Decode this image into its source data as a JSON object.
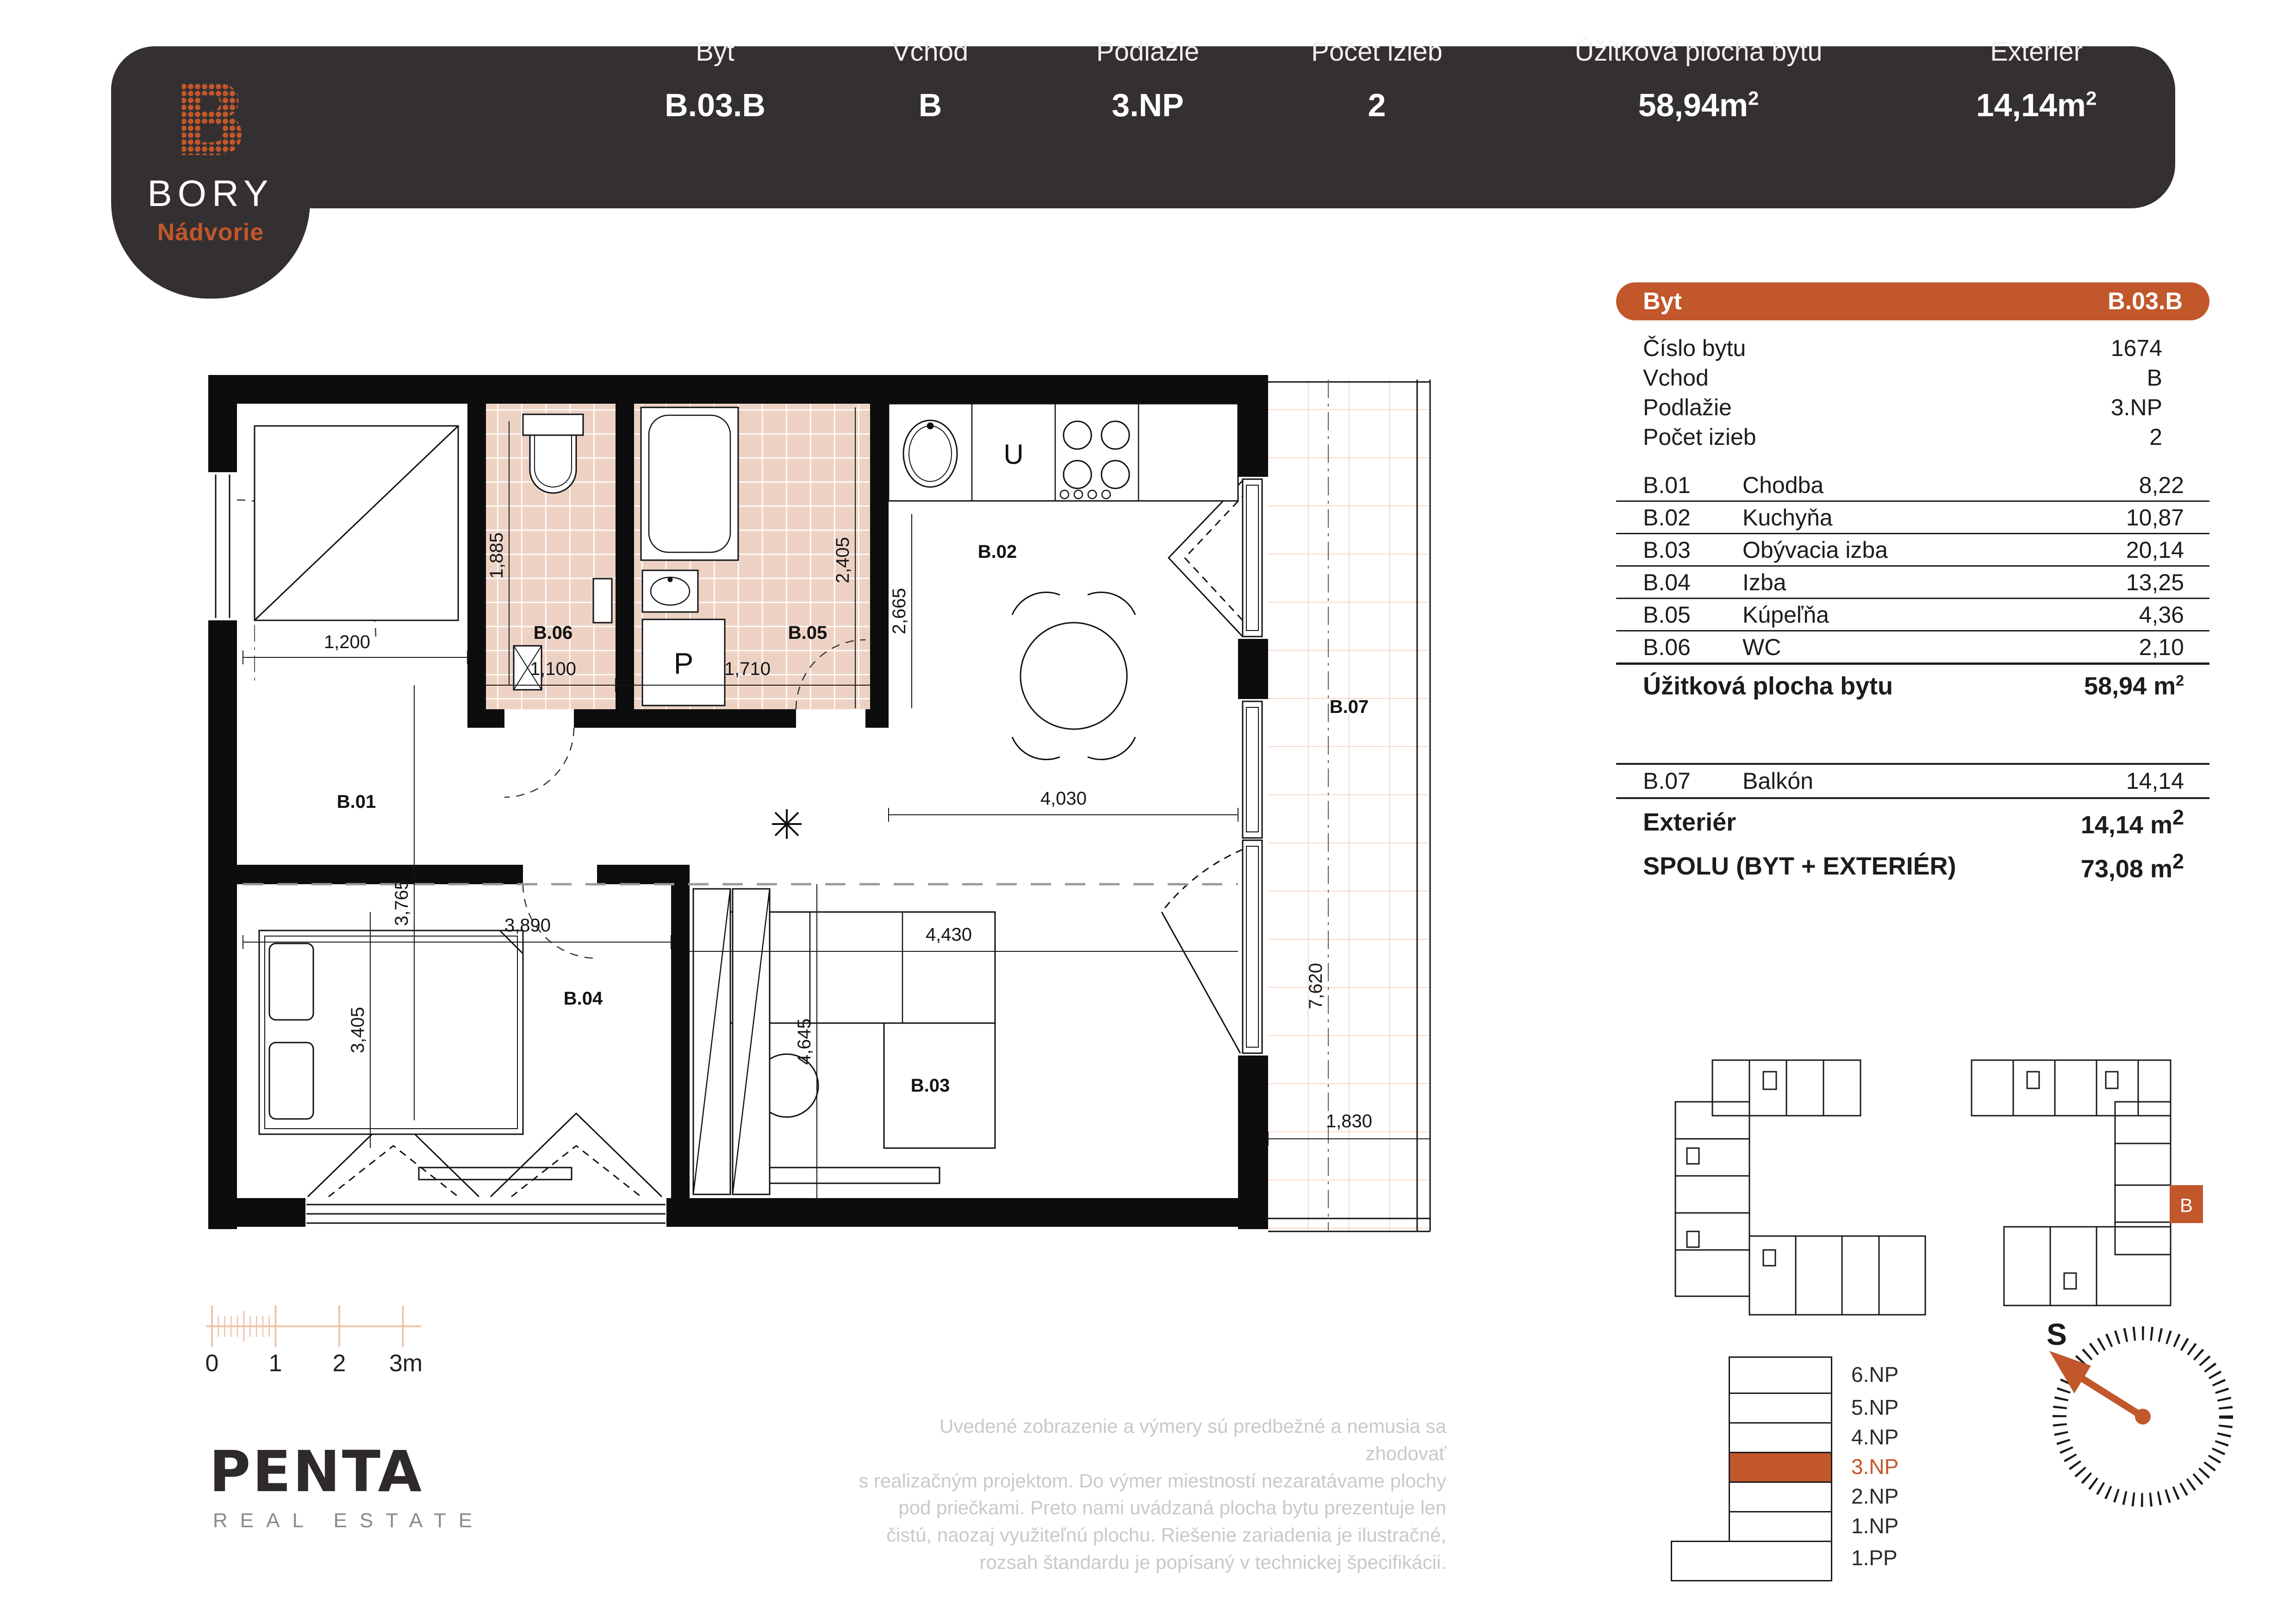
{
  "header": {
    "logo": {
      "letter": "B",
      "brand": "BORY",
      "sub": "Nádvorie"
    },
    "fields": [
      {
        "label": "Byt",
        "value": "B.03.B",
        "sup": ""
      },
      {
        "label": "Vchod",
        "value": "B",
        "sup": ""
      },
      {
        "label": "Podlažie",
        "value": "3.NP",
        "sup": ""
      },
      {
        "label": "Počet izieb",
        "value": "2",
        "sup": ""
      },
      {
        "label": "Úžitková plocha bytu",
        "value": "58,94m",
        "sup": "2"
      },
      {
        "label": "Exteriér",
        "value": "14,14m",
        "sup": "2"
      }
    ]
  },
  "info_table": {
    "head": {
      "label": "Byt",
      "value": "B.03.B"
    },
    "meta": [
      {
        "label": "Číslo bytu",
        "value": "1674"
      },
      {
        "label": "Vchod",
        "value": "B"
      },
      {
        "label": "Podlažie",
        "value": "3.NP"
      },
      {
        "label": "Počet izieb",
        "value": "2"
      }
    ],
    "rooms": [
      {
        "code": "B.01",
        "name": "Chodba",
        "area": "8,22"
      },
      {
        "code": "B.02",
        "name": "Kuchyňa",
        "area": "10,87"
      },
      {
        "code": "B.03",
        "name": "Obývacia izba",
        "area": "20,14"
      },
      {
        "code": "B.04",
        "name": "Izba",
        "area": "13,25"
      },
      {
        "code": "B.05",
        "name": "Kúpeľňa",
        "area": "4,36"
      },
      {
        "code": "B.06",
        "name": "WC",
        "area": "2,10"
      }
    ],
    "subtotal": {
      "label": "Úžitková plocha bytu",
      "value": "58,94 m",
      "sup": "2"
    },
    "balcony": {
      "code": "B.07",
      "name": "Balkón",
      "area": "14,14"
    },
    "exterior": {
      "label": "Exteriér",
      "value": "14,14 m",
      "sup": "2"
    },
    "total": {
      "label": "SPOLU (BYT + EXTERIÉR)",
      "value": "73,08 m",
      "sup": "2"
    }
  },
  "plan": {
    "rooms": {
      "b01": "B.01",
      "b02": "B.02",
      "b03": "B.03",
      "b04": "B.04",
      "b05": "B.05",
      "b06": "B.06",
      "b07": "B.07"
    },
    "dims": {
      "d1200": "1,200",
      "d1885": "1,885",
      "d1100": "1,100",
      "d1710": "1,710",
      "d2405": "2,405",
      "d2665": "2,665",
      "d4030": "4,030",
      "d3765": "3,765",
      "d3405": "3,405",
      "d3890": "3,890",
      "d4645": "4,645",
      "d4430": "4,430",
      "d7620": "7,620",
      "d1830": "1,830"
    },
    "symbols": {
      "washer": "P",
      "fridge": "U"
    }
  },
  "site_map": {
    "unit": "B"
  },
  "floors": {
    "levels": [
      {
        "label": "6.NP"
      },
      {
        "label": "5.NP"
      },
      {
        "label": "4.NP"
      },
      {
        "label": "3.NP"
      },
      {
        "label": "2.NP"
      },
      {
        "label": "1.NP"
      },
      {
        "label": "1.PP"
      }
    ],
    "active": "3.NP"
  },
  "compass": {
    "label": "S"
  },
  "scalebar": {
    "labels": [
      "0",
      "1",
      "2",
      "3m"
    ]
  },
  "disclaimer": {
    "lines": [
      "Uvedené zobrazenie a výmery sú predbežné a nemusia sa zhodovať",
      "s realizačným projektom. Do výmer miestností nezaratávame plochy",
      "pod priečkami. Preto nami uvádzaná plocha bytu prezentuje len",
      "čistú, naozaj využiteľnú plochu. Riešenie zariadenia je ilustračné,",
      "rozsah štandardu je popísaný v technickej špecifikácii."
    ]
  },
  "publisher": {
    "name": "PENTA",
    "sub": "REAL ESTATE"
  }
}
